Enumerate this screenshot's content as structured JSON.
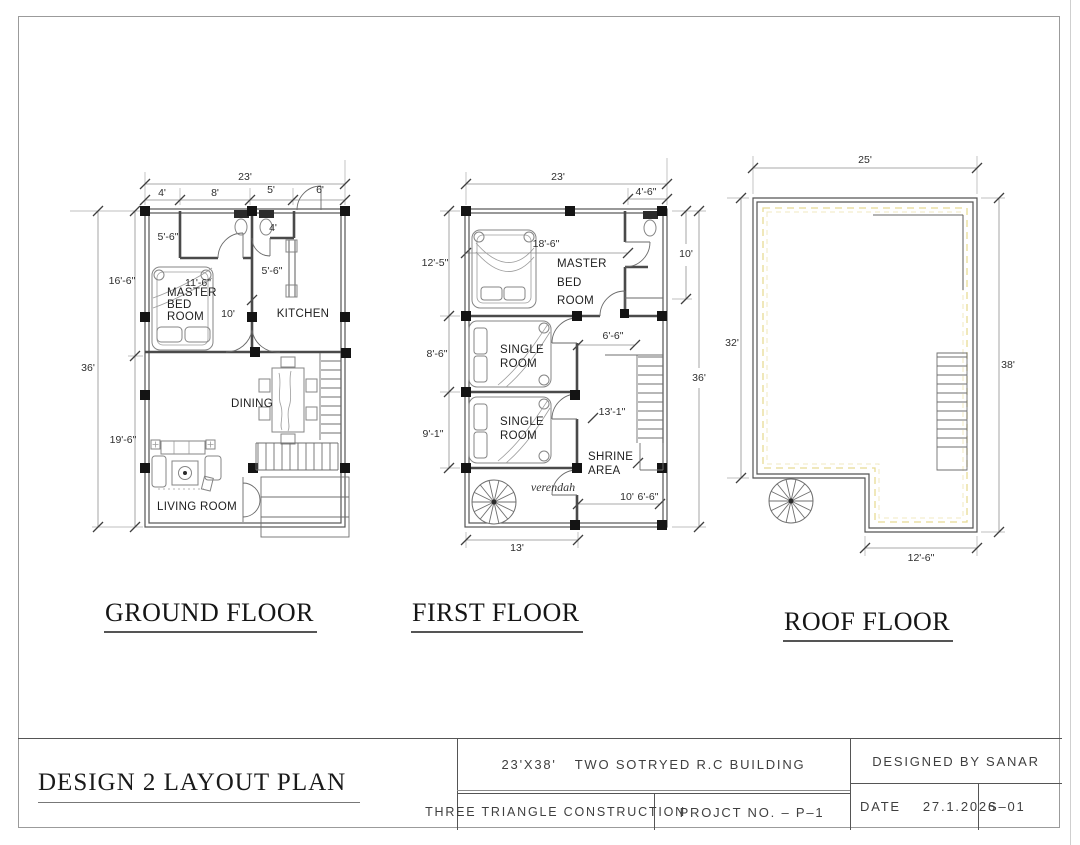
{
  "colors": {
    "wall": "#4a4a4a",
    "column": "#141414",
    "parapet": "#e7db94",
    "parapet2": "#f0e9c2"
  },
  "floors": {
    "ground": {
      "title": "GROUND FLOOR",
      "rooms": {
        "master1": "MASTER",
        "master2": "BED",
        "master3": "ROOM",
        "kitchen": "KITCHEN",
        "dining": "DINING",
        "living": "LIVING ROOM"
      },
      "dims": {
        "total_w": "23'",
        "seg_a": "4'",
        "seg_b": "8'",
        "seg_c": "5'",
        "seg_d": "6'",
        "total_h": "36'",
        "upper_h": "16'-6\"",
        "lower_h": "19'-6\"",
        "bath_l": "5'-6\"",
        "bath_r": "4'",
        "kitchen_d": "5'-6\"",
        "master_w": "11'-6\"",
        "hall_w": "10'"
      }
    },
    "first": {
      "title": "FIRST FLOOR",
      "rooms": {
        "master1": "MASTER",
        "master2": "BED",
        "master3": "ROOM",
        "single1a": "SINGLE",
        "single1b": "ROOM",
        "single2a": "SINGLE",
        "single2b": "ROOM",
        "shrine1": "SHRINE",
        "shrine2": "AREA",
        "verandah": "verendah"
      },
      "dims": {
        "total_w": "23'",
        "bath_w": "4'-6\"",
        "left_a": "12'-5\"",
        "left_b": "8'-6\"",
        "left_c": "9'-1\"",
        "right_a": "10'",
        "total_h": "36'",
        "master_w": "18'-6\"",
        "stair_w": "6'-6\"",
        "stair_len": "13'-1\"",
        "inner_a": "10'",
        "inner_b": "6'-6\"",
        "bottom_w": "13'"
      }
    },
    "roof": {
      "title": "ROOF FLOOR",
      "dims": {
        "top": "25'",
        "left": "32'",
        "right": "38'",
        "bottom": "12'-6\""
      }
    }
  },
  "titleblock": {
    "drawing_title": "DESIGN 2  LAYOUT PLAN",
    "building_size": "23'X38'",
    "building_desc": "TWO SOTRYED R.C BUILDING",
    "company": "THREE TRIANGLE CONSTRUCTION",
    "project_no": "PROJCT NO.  –  P–1",
    "designed_by": "DESIGNED BY SANAR",
    "date_label": "DATE",
    "date_value": "27.1.2026",
    "sheet_no": "S–01"
  }
}
